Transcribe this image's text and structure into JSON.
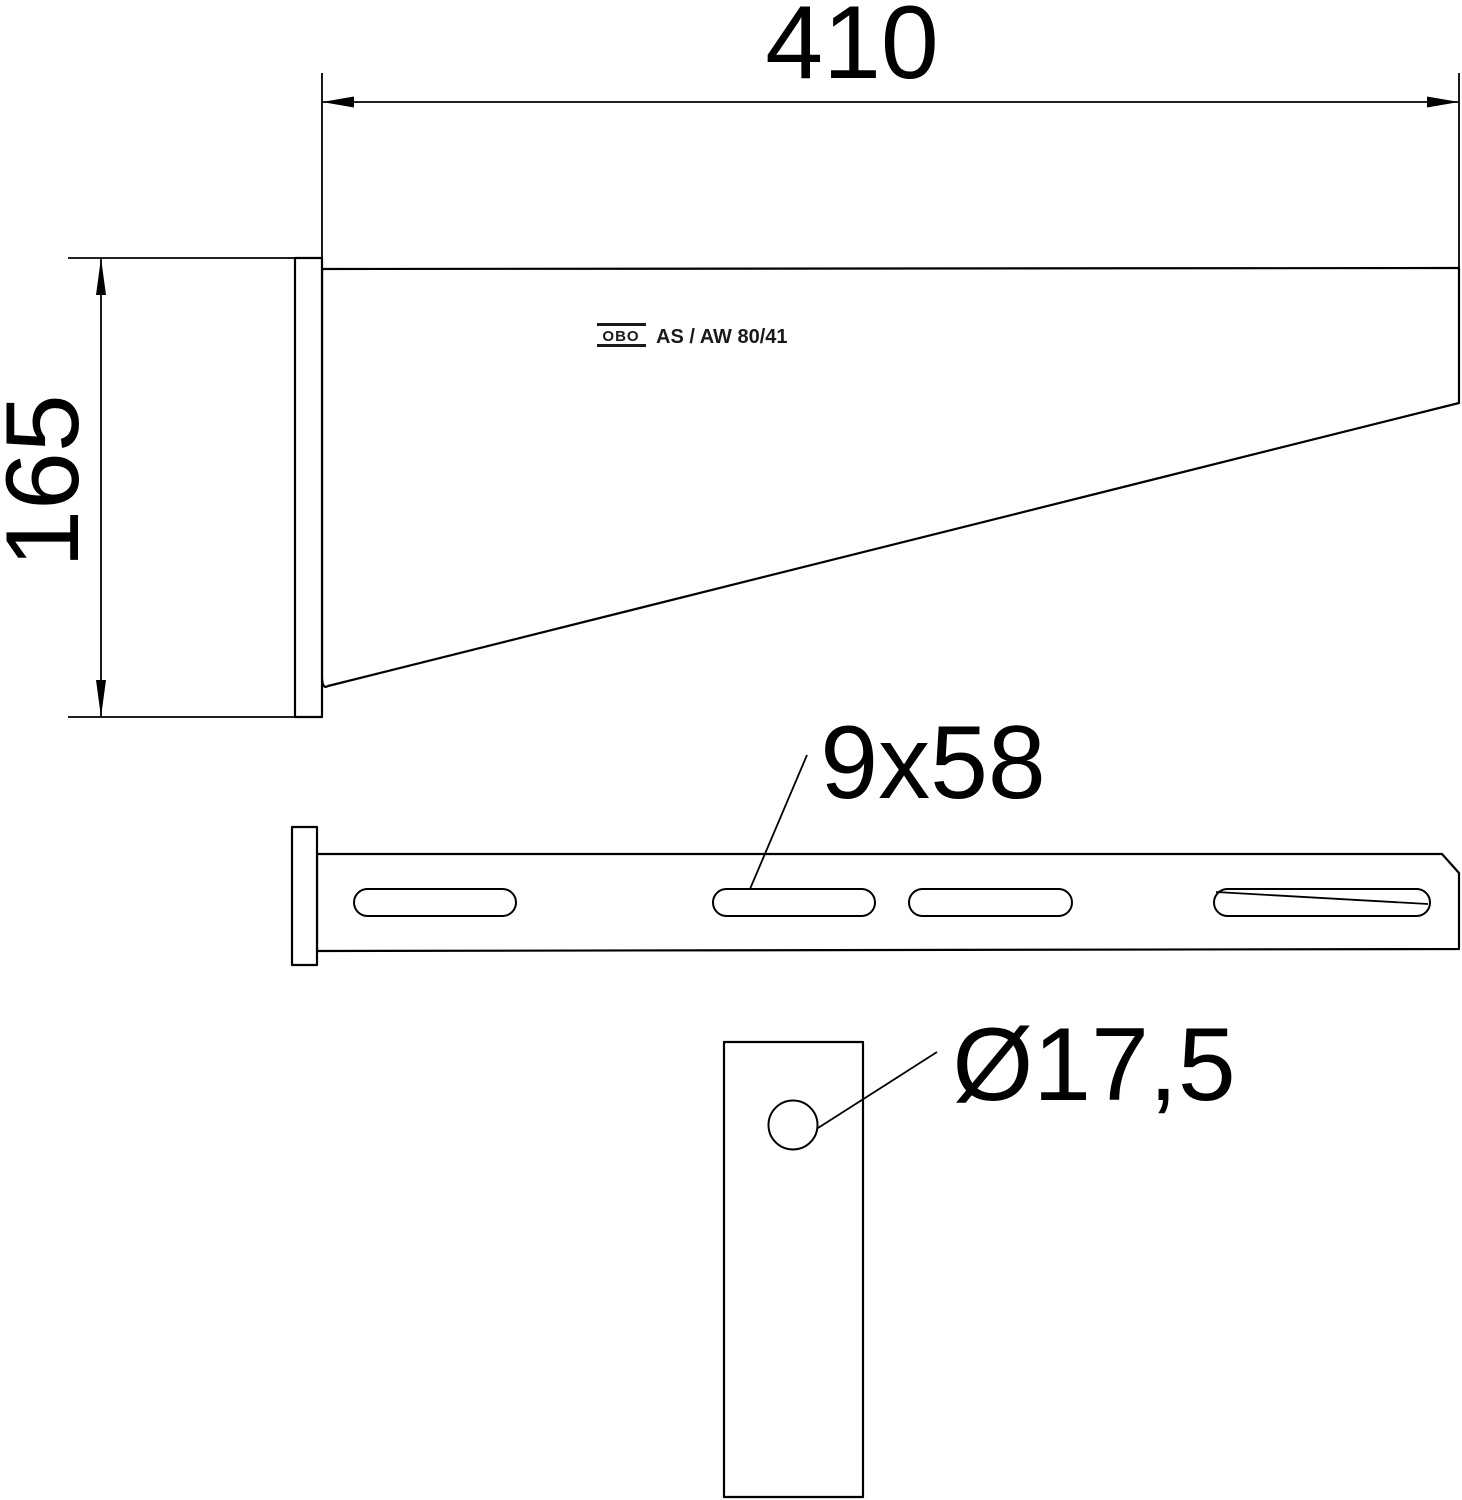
{
  "drawing": {
    "colors": {
      "line": "#000000",
      "background": "#ffffff"
    },
    "brand": {
      "logo_text": "OBO",
      "model_label": "AS / AW 80/41"
    },
    "dimensions": {
      "arm_length": "410",
      "plate_height": "165",
      "slot_size": "9x58",
      "hole_diameter": "Ø17,5"
    }
  }
}
